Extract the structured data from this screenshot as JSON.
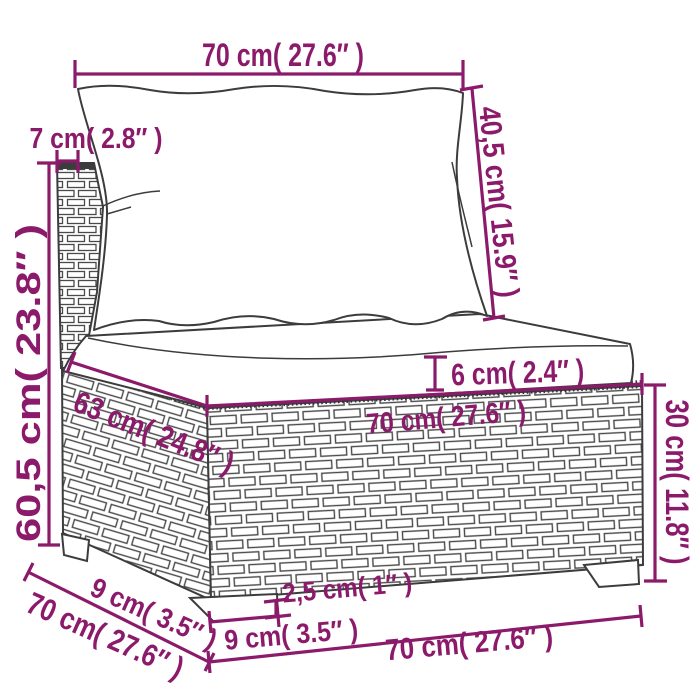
{
  "diagram": {
    "subject": "modular rattan garden sofa middle section with back pillow and seat cushion",
    "accent_color": "#8C1A6B",
    "line_color": "#3C3C3C",
    "background": "#FFFFFF",
    "dims": {
      "top_width": "70 cm( 27.6″ )",
      "back_thickness": "7 cm( 2.8″ )",
      "back_cushion_height": "40,5 cm( 15.9″ )",
      "total_height": "60,5 cm( 23.8″ )",
      "seat_depth": "63 cm( 24.8″ )",
      "seat_cushion_thickness": "6 cm( 2.4″ )",
      "seat_width": "70 cm( 27.6″ )",
      "base_height": "30 cm( 11.8″ )",
      "foot_height": "2,5 cm( 1″ )",
      "foot_width": "9 cm( 3.5″ )",
      "foot_depth": "9 cm( 3.5″ )",
      "side_depth": "70 cm( 27.6″ )",
      "bottom_width": "70 cm( 27.6″ )"
    }
  }
}
